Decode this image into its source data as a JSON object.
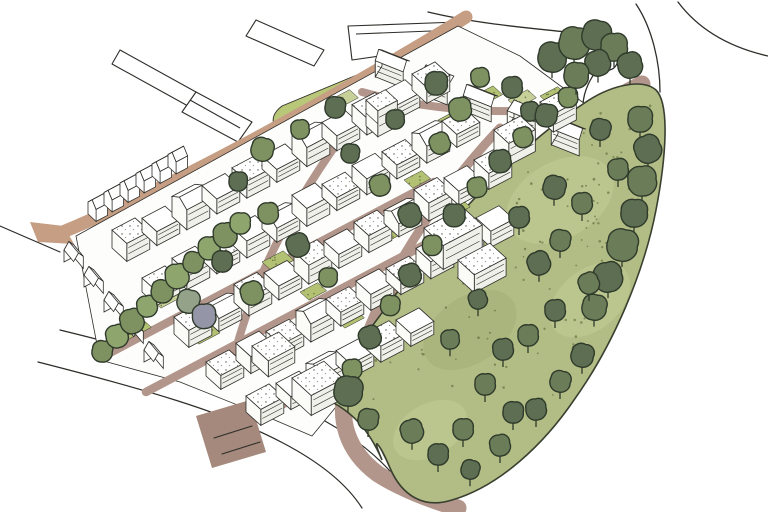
{
  "meta": {
    "title": "Aerial masterplan sketch",
    "description": "Hand-drawn axonometric architectural illustration of an urban masterplan: dense white terraced building blocks with internal streets and courtyards, surrounded by context buildings drawn in outline, a tan perimeter road, and a large tree-filled green park on the right",
    "style": "hand-drawn watercolour sketch",
    "text_content": "none"
  },
  "palette": {
    "paper": "#ffffff",
    "ink": "#2e2d29",
    "road_tan": "#c59e84",
    "road_mauve": "#b2968b",
    "road_stub": "#a4897c",
    "park_green": "#b2bd86",
    "park_light_blotch": "#c3cc96",
    "park_dark_blotch": "#a3b077",
    "lawn_green": "#b9c778",
    "court_green": "#b3c173",
    "court_light": "#c7d098",
    "court_bright": "#a8bd61",
    "grass_dot": "#6e7a48",
    "tree_dark": "#5d6e53",
    "tree_dark2": "#6b7d58",
    "tree_olive": "#7e9161",
    "tree_light": "#8fa56e",
    "tree_gray": "#93a289",
    "tree_blue": "#9496a8",
    "tree_stroke": "#2f3a2b",
    "face_shade": "#f0f0ea",
    "face_light": "#fbfbf8",
    "roof_dot": "#55564e"
  },
  "scene": {
    "courts": [
      {
        "x": 118,
        "y": 330,
        "l": 26,
        "d": 14,
        "k": "g"
      },
      {
        "x": 152,
        "y": 300,
        "l": 22,
        "d": 12,
        "k": "l"
      },
      {
        "x": 190,
        "y": 336,
        "l": 24,
        "d": 12,
        "k": "g"
      },
      {
        "x": 228,
        "y": 362,
        "l": 22,
        "d": 12,
        "k": "l"
      },
      {
        "x": 262,
        "y": 262,
        "l": 24,
        "d": 14,
        "k": "g"
      },
      {
        "x": 300,
        "y": 292,
        "l": 20,
        "d": 12,
        "k": "g"
      },
      {
        "x": 232,
        "y": 232,
        "l": 22,
        "d": 12,
        "k": "l"
      },
      {
        "x": 336,
        "y": 320,
        "l": 22,
        "d": 12,
        "k": "g"
      },
      {
        "x": 300,
        "y": 200,
        "l": 20,
        "d": 12,
        "k": "l"
      },
      {
        "x": 370,
        "y": 238,
        "l": 22,
        "d": 12,
        "k": "g"
      },
      {
        "x": 404,
        "y": 180,
        "l": 20,
        "d": 12,
        "k": "g"
      },
      {
        "x": 438,
        "y": 120,
        "l": 22,
        "d": 12,
        "k": "g"
      },
      {
        "x": 470,
        "y": 98,
        "l": 26,
        "d": 13,
        "k": "g"
      },
      {
        "x": 508,
        "y": 100,
        "l": 22,
        "d": 12,
        "k": "l"
      },
      {
        "x": 540,
        "y": 96,
        "l": 20,
        "d": 11,
        "k": "g"
      },
      {
        "x": 330,
        "y": 100,
        "l": 22,
        "d": 12,
        "k": "l"
      },
      {
        "x": 296,
        "y": 384,
        "l": 26,
        "d": 13,
        "k": "b"
      },
      {
        "x": 430,
        "y": 236,
        "l": 16,
        "d": 9,
        "k": "b"
      },
      {
        "x": 452,
        "y": 208,
        "l": 14,
        "d": 8,
        "k": "g"
      }
    ],
    "building_rows": [
      {
        "x": 382,
        "y": 66,
        "c": 5,
        "sx": 44,
        "sy": 17,
        "l": 30,
        "d": 18,
        "h": [
          16,
          18,
          15,
          17,
          16
        ],
        "g": [
          0,
          2,
          4
        ],
        "a": 1
      },
      {
        "x": 112,
        "y": 248,
        "c": 11,
        "sx": 30,
        "sy": -15.8,
        "l": 26,
        "d": 20,
        "h": [
          18,
          14,
          20,
          15,
          17,
          13,
          19,
          15,
          17,
          14,
          16
        ],
        "g": [
          2,
          6
        ]
      },
      {
        "x": 142,
        "y": 292,
        "c": 11,
        "sx": 30,
        "sy": -15.8,
        "l": 26,
        "d": 20,
        "h": [
          14,
          18,
          13,
          17,
          14,
          18,
          13,
          16,
          14,
          17,
          13
        ],
        "g": [
          4,
          9
        ]
      },
      {
        "x": 174,
        "y": 334,
        "c": 11,
        "sx": 30,
        "sy": -15.8,
        "l": 26,
        "d": 20,
        "h": [
          17,
          13,
          18,
          14,
          19,
          14,
          17,
          13,
          18,
          14,
          16
        ],
        "g": [
          1,
          7
        ]
      },
      {
        "x": 206,
        "y": 376,
        "c": 10,
        "sx": 30,
        "sy": -15.8,
        "l": 26,
        "d": 20,
        "h": [
          14,
          17,
          13,
          18,
          14,
          16,
          13,
          17,
          14,
          16
        ],
        "g": [
          3
        ]
      },
      {
        "x": 246,
        "y": 412,
        "c": 6,
        "sx": 30,
        "sy": -15.8,
        "l": 26,
        "d": 20,
        "h": [
          16,
          13,
          17,
          14,
          16,
          13
        ],
        "g": [
          2
        ]
      }
    ],
    "building_extras": [
      {
        "x": 292,
        "y": 398,
        "l": 36,
        "d": 26,
        "h": 20
      },
      {
        "x": 252,
        "y": 362,
        "l": 30,
        "d": 22,
        "h": 16
      },
      {
        "x": 424,
        "y": 252,
        "l": 44,
        "d": 26,
        "h": 24
      },
      {
        "x": 458,
        "y": 278,
        "l": 36,
        "d": 22,
        "h": 18
      },
      {
        "x": 494,
        "y": 152,
        "l": 30,
        "d": 20,
        "h": 22
      },
      {
        "x": 366,
        "y": 126,
        "l": 22,
        "d": 16,
        "h": 26,
        "t": 2
      },
      {
        "x": 540,
        "y": 120,
        "l": 26,
        "d": 18,
        "h": 18
      }
    ],
    "context_rows": [
      {
        "x": 88,
        "y": 214,
        "c": 6,
        "sx": 16,
        "sy": -9.5,
        "l": 13,
        "d": 11,
        "h": 12,
        "t": 3,
        "gable": true
      },
      {
        "x": 64,
        "y": 262,
        "c": 5,
        "sx": 20,
        "sy": 25,
        "l": 15,
        "d": 11,
        "h": 12,
        "t": 3,
        "gable": true,
        "a": 2
      }
    ],
    "trees": {
      "street_sw": {
        "kinds": [
          "o",
          "l"
        ],
        "pts": [
          [
            102,
            352
          ],
          [
            117,
            337
          ],
          [
            132,
            322
          ],
          [
            147,
            307
          ],
          [
            162,
            292
          ],
          [
            177,
            277
          ],
          [
            193,
            263
          ],
          [
            209,
            249
          ],
          [
            225,
            236
          ],
          [
            240,
            224
          ]
        ]
      },
      "street_special": [
        {
          "x": 188,
          "y": 302,
          "k": "g",
          "s": 1.1
        },
        {
          "x": 204,
          "y": 317,
          "k": "b",
          "s": 1.15
        }
      ],
      "spine": {
        "kinds": [
          "o",
          "d"
        ],
        "pts": [
          [
            352,
            370
          ],
          [
            370,
            338
          ],
          [
            390,
            306
          ],
          [
            410,
            276
          ],
          [
            432,
            246
          ],
          [
            454,
            216
          ],
          [
            477,
            188
          ],
          [
            500,
            162
          ],
          [
            523,
            138
          ],
          [
            546,
            116
          ],
          [
            568,
            98
          ]
        ]
      },
      "courtyard": {
        "kinds": [
          "d",
          "o"
        ],
        "pts": [
          [
            238,
            182
          ],
          [
            268,
            214
          ],
          [
            298,
            246
          ],
          [
            328,
            278
          ],
          [
            222,
            262
          ],
          [
            252,
            294
          ],
          [
            350,
            154
          ],
          [
            380,
            186
          ],
          [
            410,
            216
          ],
          [
            300,
            130
          ],
          [
            335,
            108
          ],
          [
            262,
            150
          ],
          [
            395,
            120
          ],
          [
            440,
            144
          ],
          [
            436,
            84
          ],
          [
            480,
            78
          ],
          [
            512,
            88
          ],
          [
            460,
            110
          ],
          [
            530,
            112
          ]
        ]
      },
      "park": {
        "kinds": [
          "d",
          "d2"
        ],
        "pts": [
          [
            552,
            58,
            1.4
          ],
          [
            574,
            44,
            1.5
          ],
          [
            596,
            36,
            1.4
          ],
          [
            614,
            48,
            1.3
          ],
          [
            598,
            64,
            1.2
          ],
          [
            576,
            76,
            1.2
          ],
          [
            630,
            66,
            1.2
          ],
          [
            640,
            120,
            1.2
          ],
          [
            648,
            150,
            1.3
          ],
          [
            642,
            182,
            1.4
          ],
          [
            634,
            214,
            1.3
          ],
          [
            622,
            246,
            1.5
          ],
          [
            608,
            278,
            1.4
          ],
          [
            594,
            308,
            1.2
          ],
          [
            554,
            188,
            1.1
          ],
          [
            582,
            204,
            1.0
          ],
          [
            519,
            218,
            1.0
          ],
          [
            560,
            241,
            1.0
          ],
          [
            539,
            264,
            1.1
          ],
          [
            589,
            284,
            1.0
          ],
          [
            555,
            311,
            1.0
          ],
          [
            528,
            336,
            1.0
          ],
          [
            503,
            350,
            1.0
          ],
          [
            485,
            385,
            1.0
          ],
          [
            513,
            413,
            1.0
          ],
          [
            463,
            430,
            1.0
          ],
          [
            438,
            455,
            1.0
          ],
          [
            412,
            432,
            1.1
          ],
          [
            348,
            392,
            1.4
          ],
          [
            368,
            420,
            1.0
          ],
          [
            600,
            130,
            1.0
          ],
          [
            618,
            170,
            1.0
          ],
          [
            478,
            300,
            0.9
          ],
          [
            450,
            340,
            0.9
          ],
          [
            582,
            356,
            1.1
          ],
          [
            560,
            382,
            1.0
          ],
          [
            536,
            410,
            1.0
          ],
          [
            500,
            446,
            1.0
          ],
          [
            470,
            470,
            0.9
          ]
        ]
      }
    },
    "park_dot_count": 110,
    "lane_markings": [
      [
        214,
        438,
        252,
        426
      ],
      [
        222,
        454,
        260,
        442
      ]
    ]
  }
}
